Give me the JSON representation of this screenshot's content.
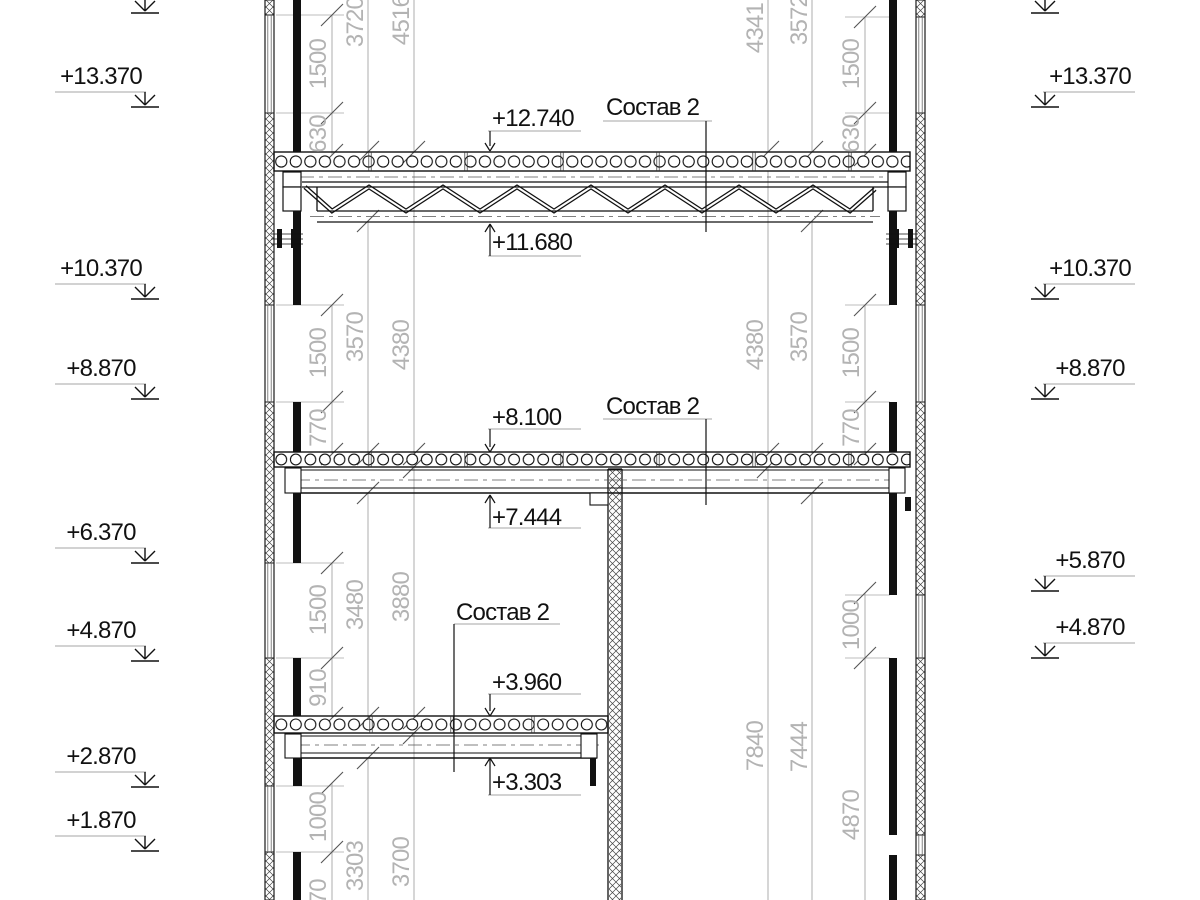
{
  "marks_left": [
    {
      "value": "+13.370"
    },
    {
      "value": "+10.370"
    },
    {
      "value": "+8.870"
    },
    {
      "value": "+6.370"
    },
    {
      "value": "+4.870"
    },
    {
      "value": "+2.870"
    },
    {
      "value": "+1.870"
    }
  ],
  "marks_right": [
    {
      "value": "+13.370"
    },
    {
      "value": "+10.370"
    },
    {
      "value": "+8.870"
    },
    {
      "value": "+5.870"
    },
    {
      "value": "+4.870"
    }
  ],
  "callouts": {
    "e12740": "+12.740",
    "e11680": "+11.680",
    "e8100": "+8.100",
    "e7444": "+7.444",
    "e3960": "+3.960",
    "e3303": "+3.303"
  },
  "section_labels": {
    "sostav2": "Состав 2"
  },
  "dims": {
    "left_a": [
      "1500",
      "630",
      "1500",
      "770",
      "1500",
      "910",
      "1000",
      "770"
    ],
    "left_b": [
      "3720",
      "3570",
      "3480",
      "3303"
    ],
    "left_c": [
      "4516",
      "4380",
      "3880",
      "3700"
    ],
    "right_a": [
      "1500",
      "630",
      "1500",
      "770",
      "1000",
      "4870"
    ],
    "right_b": [
      "3572",
      "3570",
      "7444"
    ],
    "right_c": [
      "4341",
      "4380",
      "7840"
    ]
  },
  "colors": {
    "line": "#1a1a1a",
    "dim_text": "#b3b3b3",
    "dim_line": "#a6a6a6",
    "underline": "#888888"
  }
}
